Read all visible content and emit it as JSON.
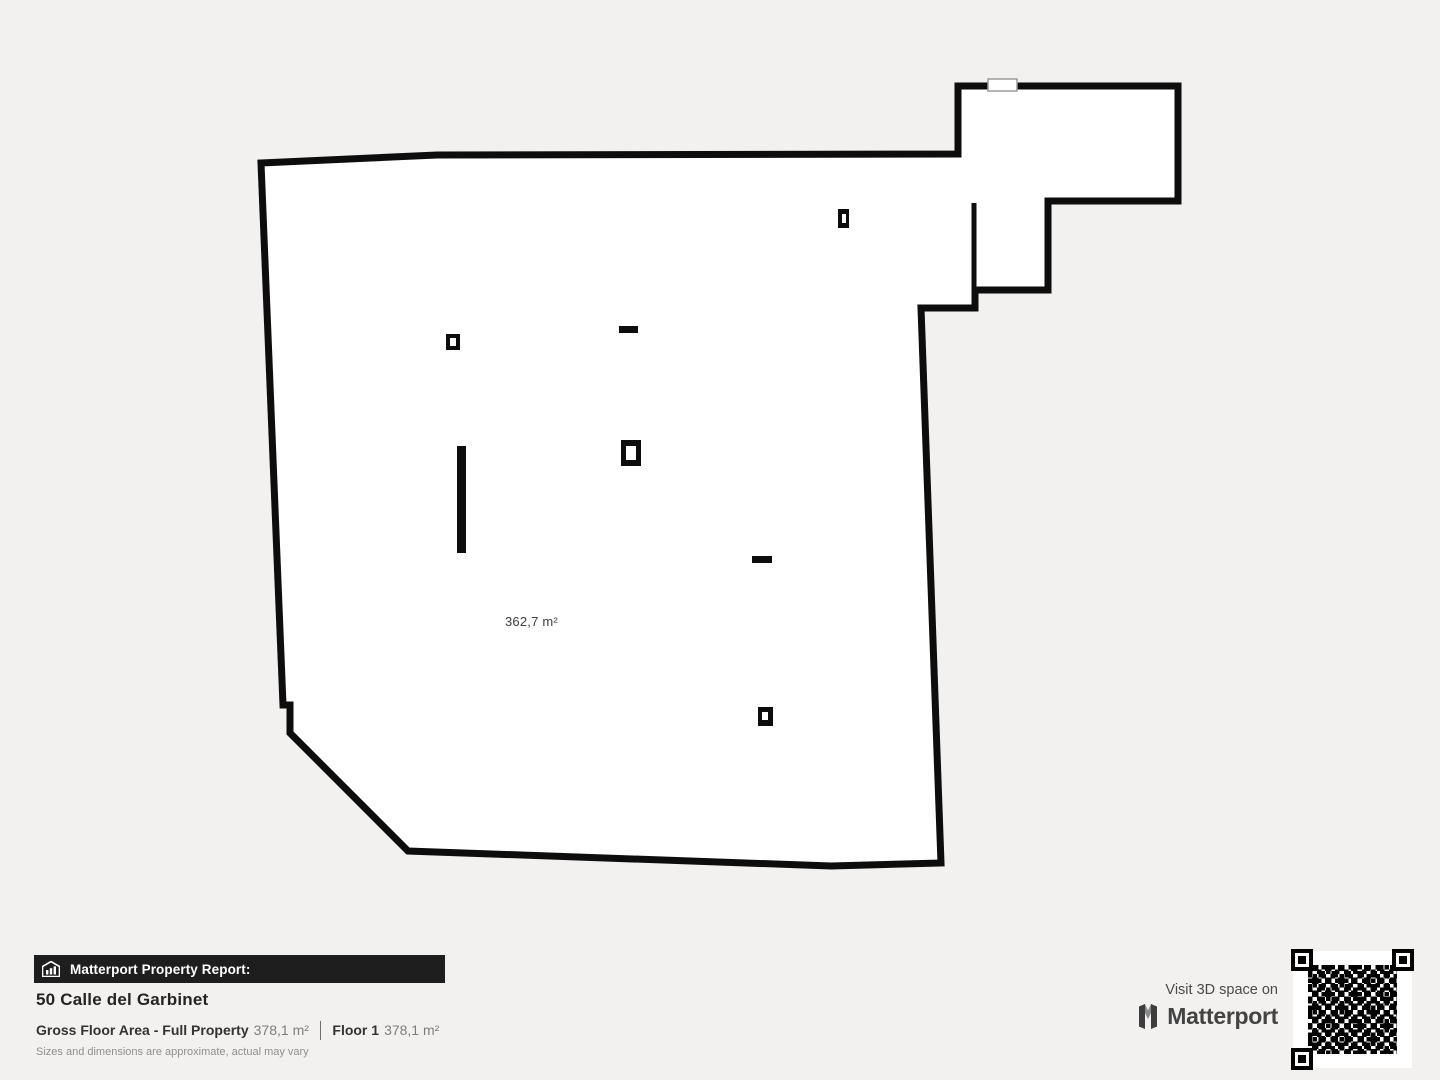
{
  "floor_plan": {
    "area_label": "362,7 m²"
  },
  "report": {
    "banner_label": "Matterport Property Report:",
    "address": "50 Calle del Garbinet",
    "gross_floor_area_label": "Gross Floor Area - Full Property",
    "gross_floor_area_value": "378,1 m²",
    "floor_label": "Floor 1",
    "floor_value": "378,1 m²",
    "disclaimer": "Sizes and dimensions are approximate, actual may vary"
  },
  "cta": {
    "visit_text": "Visit 3D space on",
    "brand": "Matterport"
  },
  "icons": {
    "banner_icon": "house-with-bars-icon",
    "logo_icon": "matterport-m-icon",
    "qr": "qr-code"
  },
  "colors": {
    "background": "#f3f1ef",
    "walls": "#0d0d0d",
    "plan_fill": "#ffffff",
    "banner_bg": "#1e1e1e",
    "banner_text": "#ffffff",
    "value_text": "#7d7d7d"
  }
}
